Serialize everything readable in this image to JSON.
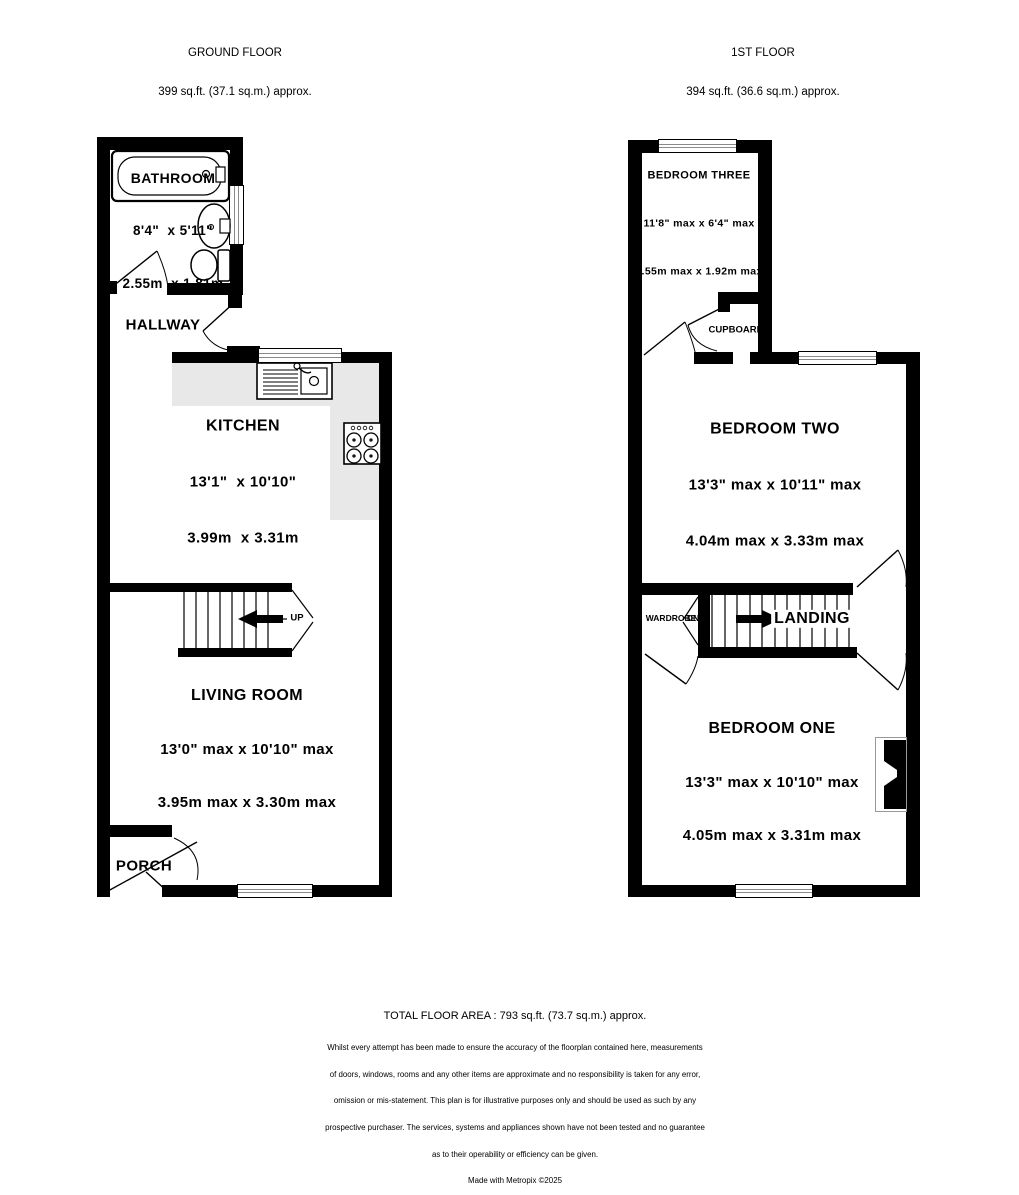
{
  "colors": {
    "wall": "#000000",
    "counter": "#e8e8e8",
    "background": "#ffffff"
  },
  "ground_floor": {
    "title": "GROUND FLOOR",
    "area": "399 sq.ft. (37.1 sq.m.) approx.",
    "bathroom_name": "BATHROOM",
    "bathroom_imperial": "8'4\"  x 5'11\"",
    "bathroom_metric": "2.55m  x 1.81m",
    "hallway_name": "HALLWAY",
    "kitchen_name": "KITCHEN",
    "kitchen_imperial": "13'1\"  x 10'10\"",
    "kitchen_metric": "3.99m  x 3.31m",
    "living_name": "LIVING ROOM",
    "living_imperial": "13'0\" max x 10'10\" max",
    "living_metric": "3.95m max x 3.30m max",
    "porch_name": "PORCH",
    "stairs_label": "UP"
  },
  "first_floor": {
    "title": "1ST FLOOR",
    "area": "394 sq.ft. (36.6 sq.m.) approx.",
    "bedroom3_name": "BEDROOM THREE",
    "bedroom3_imperial": "11'8\" max x 6'4\" max",
    "bedroom3_metric": "3.55m max x 1.92m max",
    "cupboard_name": "CUPBOARD",
    "bedroom2_name": "BEDROOM TWO",
    "bedroom2_imperial": "13'3\" max x 10'11\" max",
    "bedroom2_metric": "4.04m max x 3.33m max",
    "wardrobe_name": "WARDROBE",
    "stairs_label": "DN",
    "landing_name": "LANDING",
    "bedroom1_name": "BEDROOM ONE",
    "bedroom1_imperial": "13'3\" max x 10'10\" max",
    "bedroom1_metric": "4.05m max x 3.31m max"
  },
  "footer": {
    "total": "TOTAL FLOOR AREA : 793 sq.ft. (73.7 sq.m.) approx.",
    "disclaimer": [
      "Whilst every attempt has been made to ensure the accuracy of the floorplan contained here, measurements",
      "of doors, windows, rooms and any other items are approximate and no responsibility is taken for any error,",
      "omission or mis-statement. This plan is for illustrative purposes only and should be used as such by any",
      "prospective purchaser. The services, systems and appliances shown have not been tested and no guarantee",
      "as to their operability or efficiency can be given.",
      "Made with Metropix ©2025"
    ]
  }
}
